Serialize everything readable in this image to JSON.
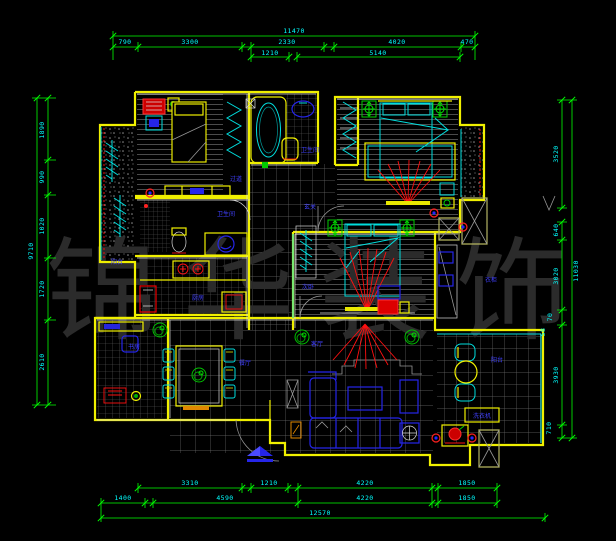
{
  "watermark": "锦华装饰",
  "dims": {
    "top": {
      "total": "11470",
      "row": [
        "790",
        "3300",
        "2330",
        "4020",
        "470"
      ],
      "row2": [
        "1210",
        "5140"
      ]
    },
    "bottom": {
      "row1": [
        "3310",
        "1210",
        "4220",
        "1850"
      ],
      "row2": [
        "1400",
        "4590",
        "4220",
        "1850"
      ],
      "total": "12570"
    },
    "left": {
      "total": "9710",
      "chain": [
        "1890",
        "990",
        "1020",
        "1720",
        "2610"
      ]
    },
    "right": {
      "total": "11030",
      "chain": [
        "3520",
        "640",
        "3020",
        "3930",
        "710"
      ],
      "small": [
        "58",
        "70"
      ]
    }
  },
  "labels": {
    "bath1": "卫生间",
    "hall1": "过道",
    "hall2": "玄关",
    "bath2": "卫生间",
    "kitchen": "厨房",
    "bed2": "次卧",
    "study": "书房",
    "dining": "餐厅",
    "living": "客厅",
    "balcony_left": "阳台",
    "balcony_right": "阳台",
    "closet": "衣柜",
    "washer": "洗衣机"
  }
}
